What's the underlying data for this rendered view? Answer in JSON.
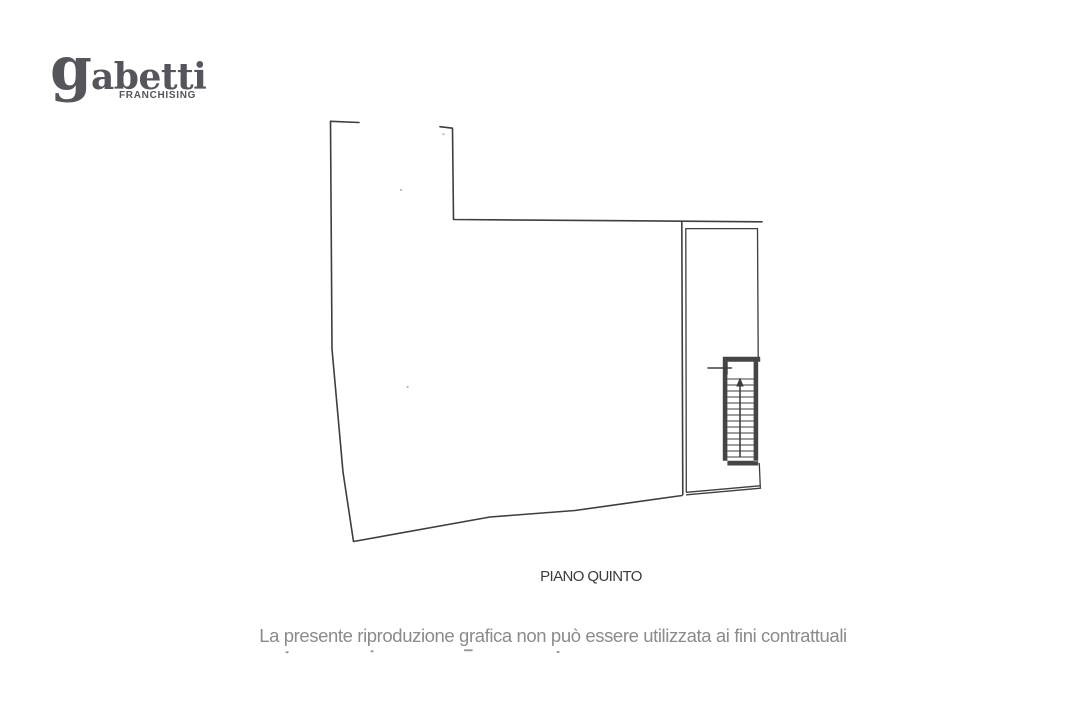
{
  "page": {
    "background": "#ffffff",
    "width": 1080,
    "height": 720
  },
  "logo": {
    "brand_initial": "g",
    "brand_rest": "abetti",
    "subtitle": "FRANCHISING",
    "color": "#54565b"
  },
  "plan": {
    "floor_label": "PIANO QUINTO",
    "line_color": "#3e3e3e",
    "wall_fill": "#454545",
    "speck_color": "#b9b9b9",
    "geometry": {
      "outline_left_bottom": "330.5,121.3 332,349 343,472 353.5,541.5 490,517 575,510.5 682,495.5",
      "top_segment_1": "330.5,121.3 359,122.5",
      "top_segment_2": "440,126.7 452.5,128.2 453.5,219.5 762,221.8",
      "right_wall": "681.8,221.8 682.8,494.5",
      "annex_inner": "686.3,491.5 685.8,228.6 757.5,228.6 758.2,356.8",
      "annex_right_lower": "759.3,463.5 760.3,487",
      "annex_bottom_upper": "686.5,492.3 759.8,485.8",
      "annex_bottom_lower": "686.5,494.8 760.6,488.2",
      "stair_walls": "M722.8,356.8 h37.4 v5 h-37.4 Z M722.8,361.8 h4.6 v103.7 h-4.6 Z M753.6,361.8 h4.6 v99.4 h-4.6 Z M722.8,460.8 h35.4 v4.7 h-35.4 Z",
      "stair_treads": "M727.4,379 h26.2 M727.4,385 h26.2 M727.4,391 h26.2 M727.4,397 h26.2 M727.4,403 h26.2 M727.4,409 h26.2 M727.4,415 h26.2 M727.4,421 h26.2 M727.4,427 h26.2 M727.4,433 h26.2 M727.4,439 h26.2 M727.4,445 h26.2 M727.4,451 h26.2 M727.4,457 h26.2",
      "stair_arrow_shaft": "M740,456.5 V385.5",
      "stair_arrow_head": "740,377.5 736.2,386.5 743.8,386.5",
      "landing_cross": "M708,368 h23.5 M727,362.4 v11.6",
      "specks": "M400.8,190 h0.4 M407.4,387 h0.4 M443.3,134.3 h0.4"
    }
  },
  "disclaimer": {
    "line1": "La presente riproduzione grafica non può essere utilizzata ai fini contrattuali",
    "color": "#8b8b8b",
    "clipped_second_line_marks": "M286.5,652.3 h1.2 M371.5,651.3 h1.2 M464.8,650.3 h7 M557.5,652 h1.2",
    "clipped_marks_color": "#9b9b9b"
  }
}
